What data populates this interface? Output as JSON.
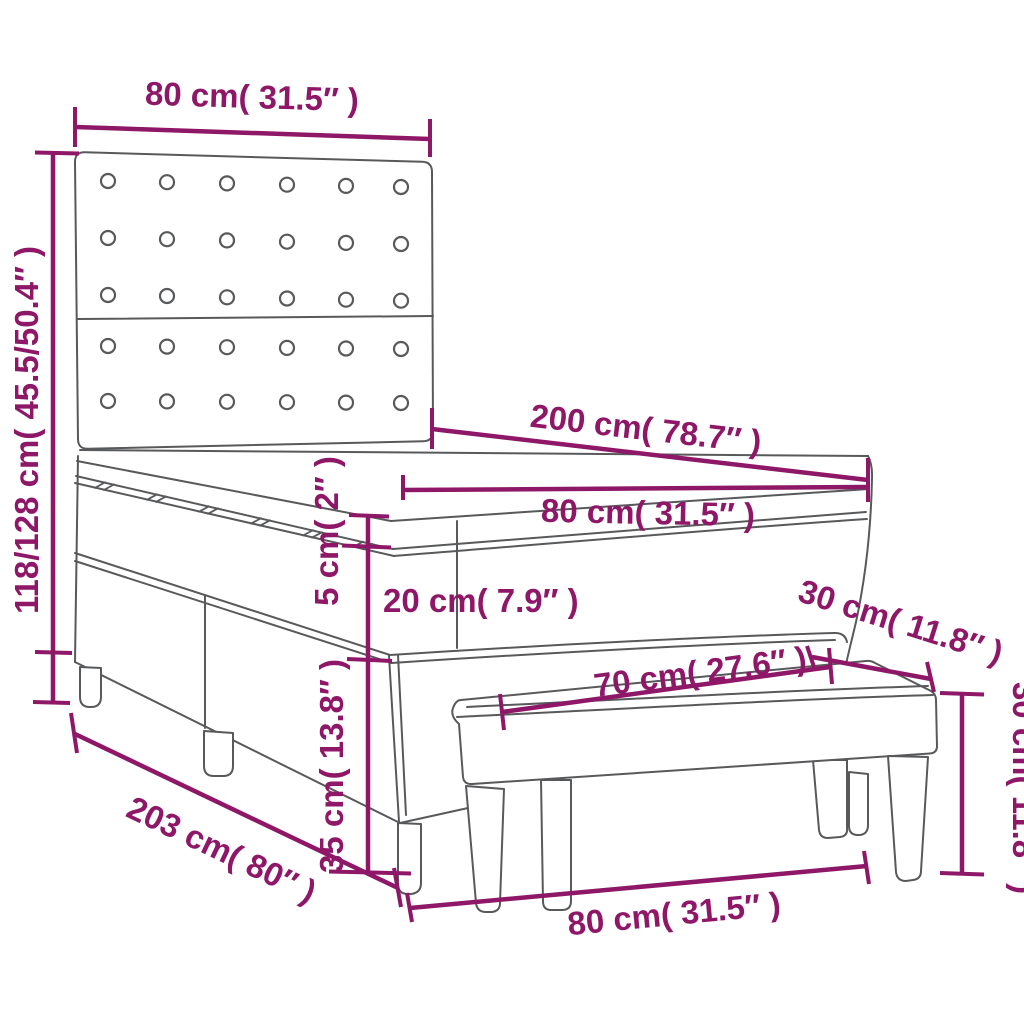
{
  "meta": {
    "background": "#FFFFFF",
    "line_color": "#58595B",
    "accent_color": "#8E1768",
    "product": "box spring bed with tufted headboard, mattress topper and bench"
  },
  "dims": {
    "headboard_width": "80 cm( 31.5″ )",
    "headboard_height": "118/128 cm( 45.5/50.4″ )",
    "bed_length": "200 cm( 78.7″ )",
    "mattress_width": "80 cm( 31.5″ )",
    "topper_thickness": "5 cm( 2″ )",
    "mattress_thickness": "20 cm( 7.9″ )",
    "base_height": "35 cm( 13.8″ )",
    "total_length": "203 cm( 80″ )",
    "footprint_width": "80 cm( 31.5″ )",
    "bench_length": "70 cm( 27.6″ )",
    "bench_depth": "30 cm( 11.8″ )",
    "bench_height": "30 cm( 11.8″ )"
  }
}
